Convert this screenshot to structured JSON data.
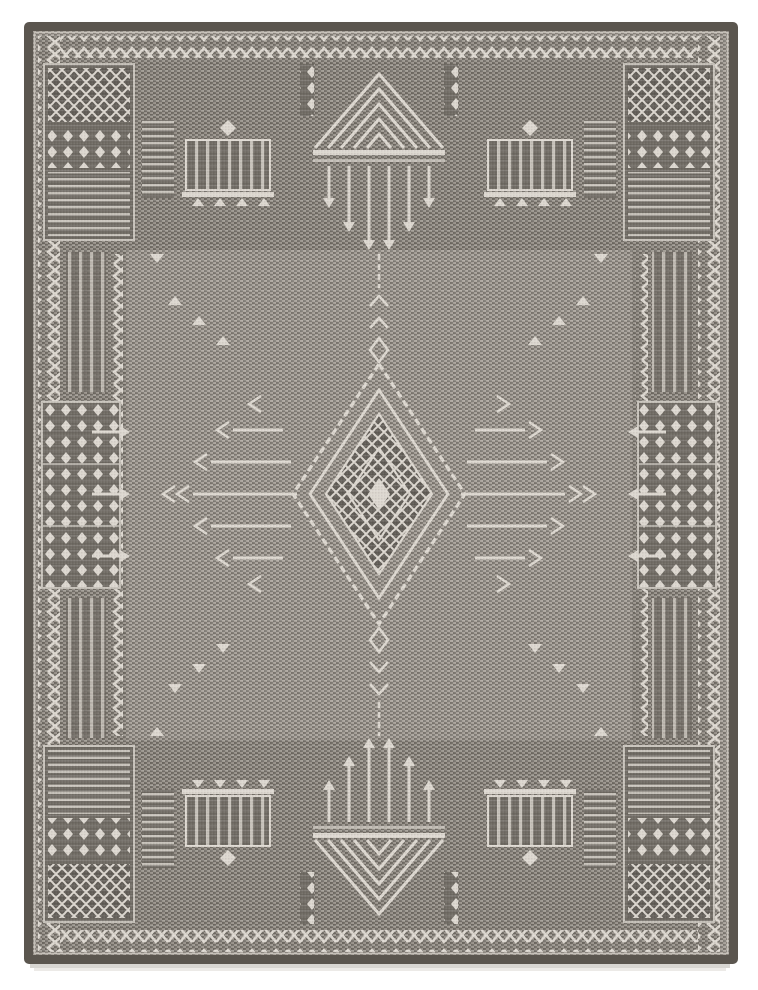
{
  "image": {
    "alt": "Photograph of a rectangular gray flatweave area rug with an ivory tribal geometric pattern: a dark bound edge, zigzag border bands, lattice corner blocks, comb and chevron-pyramid motifs at top and bottom, and a central stepped diamond medallion with winged bars on a finely striated gray field, shown on a white background.",
    "width": 758,
    "height": 990
  },
  "colors": {
    "bg": "#ffffff",
    "binding": "#5b564f",
    "selvage": "#cfcac3",
    "frame_dark": "#6f6a63",
    "frame_light": "#9b958d",
    "field_dark": "#7d7871",
    "field_light": "#aaa49c",
    "lattice_bg": "#615c56",
    "motif": "#dcd7cf",
    "motif_soft": "#c6c1b9",
    "shadow": "#d8d6d2",
    "shadow_soft": "#eceae7"
  }
}
